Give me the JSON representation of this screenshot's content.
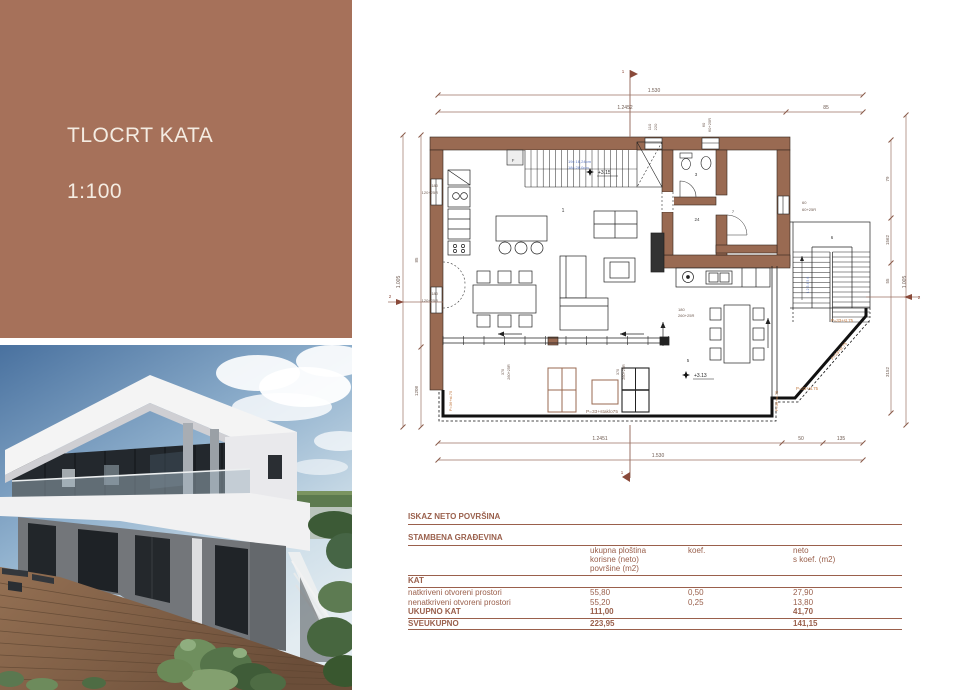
{
  "title_panel": {
    "title": "TLOCRT KATA",
    "scale": "1:100"
  },
  "colors": {
    "panel": "#a6715a",
    "wall": "#996a52",
    "dim_line": "#9b7265",
    "table_text": "#9a604c",
    "stair_note": "#5f7bc4",
    "surface_note": "#c07840"
  },
  "plan": {
    "texts": [
      {
        "t": "1.530",
        "x": 654,
        "y": 92
      },
      {
        "t": "1.2452",
        "x": 625,
        "y": 109
      },
      {
        "t": "85",
        "x": 826,
        "y": 109
      },
      {
        "t": "1",
        "x": 623,
        "y": 73,
        "s": 4.5,
        "c": "#8a4a3a"
      },
      {
        "t": "110",
        "x": 651,
        "y": 127,
        "r": -90,
        "s": 4
      },
      {
        "t": "220",
        "x": 657,
        "y": 127,
        "r": -90,
        "s": 4
      },
      {
        "t": "60",
        "x": 705,
        "y": 125,
        "r": -90,
        "s": 4
      },
      {
        "t": "60+25R",
        "x": 711,
        "y": 125,
        "r": -90,
        "s": 4
      },
      {
        "t": "79",
        "x": 889,
        "y": 179,
        "r": -90,
        "s": 4.5
      },
      {
        "t": "1562",
        "x": 889,
        "y": 240,
        "r": -90,
        "s": 4.5
      },
      {
        "t": "55",
        "x": 889,
        "y": 281,
        "r": -90,
        "s": 4.5
      },
      {
        "t": "3152",
        "x": 889,
        "y": 372,
        "r": -90,
        "s": 4.5
      },
      {
        "t": "1.005",
        "x": 906,
        "y": 282,
        "r": -90
      },
      {
        "t": "2",
        "x": 919,
        "y": 299,
        "s": 4.5,
        "c": "#8a4a3a"
      },
      {
        "t": "60",
        "x": 802,
        "y": 204,
        "s": 4,
        "a": "start"
      },
      {
        "t": "60+25R",
        "x": 802,
        "y": 211,
        "s": 4,
        "a": "start"
      },
      {
        "t": "1.005",
        "x": 400,
        "y": 282,
        "r": -90
      },
      {
        "t": "85",
        "x": 418,
        "y": 260,
        "r": -90,
        "s": 4.5
      },
      {
        "t": "1208",
        "x": 418,
        "y": 391,
        "r": -90,
        "s": 4.5
      },
      {
        "t": "2",
        "x": 390,
        "y": 298,
        "s": 4.5,
        "c": "#8a4a3a"
      },
      {
        "t": "180",
        "x": 438,
        "y": 187,
        "s": 4,
        "a": "end"
      },
      {
        "t": "120+25R",
        "x": 438,
        "y": 194,
        "s": 4,
        "a": "end"
      },
      {
        "t": "180",
        "x": 438,
        "y": 295,
        "s": 4,
        "a": "end"
      },
      {
        "t": "120+25R",
        "x": 438,
        "y": 302,
        "s": 4,
        "a": "end"
      },
      {
        "t": "1.2451",
        "x": 600,
        "y": 440
      },
      {
        "t": "50",
        "x": 801,
        "y": 440
      },
      {
        "t": "135",
        "x": 841,
        "y": 440
      },
      {
        "t": "1.530",
        "x": 658,
        "y": 457
      },
      {
        "t": "1",
        "x": 622,
        "y": 474,
        "s": 4.5,
        "c": "#8a4a3a"
      },
      {
        "t": "370",
        "x": 504,
        "y": 372,
        "r": -90,
        "s": 3.8
      },
      {
        "t": "260+25R",
        "x": 510,
        "y": 372,
        "r": -90,
        "s": 3.8
      },
      {
        "t": "370",
        "x": 619,
        "y": 372,
        "r": -90,
        "s": 3.8
      },
      {
        "t": "260+25R",
        "x": 625,
        "y": 372,
        "r": -90,
        "s": 3.8
      },
      {
        "t": "180",
        "x": 678,
        "y": 311,
        "s": 4,
        "a": "start"
      },
      {
        "t": "260+25R",
        "x": 678,
        "y": 317,
        "s": 4,
        "a": "start"
      },
      {
        "t": "1",
        "x": 563,
        "y": 212,
        "s": 5,
        "c": "#3a3a3a"
      },
      {
        "t": "3",
        "x": 696,
        "y": 176,
        "s": 4.5,
        "c": "#3a3a3a"
      },
      {
        "t": "24",
        "x": 697,
        "y": 221,
        "s": 4.5,
        "c": "#3a3a3a"
      },
      {
        "t": "7",
        "x": 733,
        "y": 213,
        "s": 4,
        "c": "#3a3a3a"
      },
      {
        "t": "6",
        "x": 832,
        "y": 239,
        "s": 4.5,
        "c": "#3a3a3a"
      },
      {
        "t": "5",
        "x": 688,
        "y": 362,
        "s": 4.5,
        "c": "#3a3a3a"
      },
      {
        "t": "+3.15",
        "x": 598,
        "y": 174,
        "s": 5,
        "a": "start",
        "c": "#222222"
      },
      {
        "t": "+3.13",
        "x": 694,
        "y": 377,
        "s": 5,
        "a": "start",
        "c": "#222222"
      },
      {
        "t": "F",
        "x": 513,
        "y": 162,
        "s": 4.5,
        "c": "#555555"
      },
      {
        "t": "19x 16,24cm",
        "x": 568,
        "y": 163,
        "s": 4,
        "c": "#5f7bc4",
        "a": "start"
      },
      {
        "t": "18x 28,0cm",
        "x": 568,
        "y": 169,
        "s": 4,
        "c": "#5f7bc4",
        "a": "start"
      },
      {
        "t": "P=33+staklo75",
        "x": 602,
        "y": 413,
        "s": 4.8,
        "c": "#8a6a58"
      },
      {
        "t": "P=33+st.75",
        "x": 831,
        "y": 322,
        "s": 4.3,
        "c": "#c07840",
        "a": "start"
      },
      {
        "t": "P=33+st.75",
        "x": 840,
        "y": 352,
        "s": 4.3,
        "c": "#c07840",
        "r": -49
      },
      {
        "t": "P=33+st.75",
        "x": 796,
        "y": 390,
        "s": 4.3,
        "c": "#c07840",
        "a": "start"
      },
      {
        "t": "P=36+st.75",
        "x": 778,
        "y": 401,
        "s": 4,
        "c": "#c07840",
        "r": -90
      },
      {
        "t": "P=36+st.75",
        "x": 452,
        "y": 401,
        "s": 4,
        "c": "#c07840",
        "r": -90
      },
      {
        "t": "1 2 3 4 5 6",
        "x": 809,
        "y": 285,
        "s": 3.5,
        "c": "#5f7bc4",
        "r": -90
      }
    ]
  },
  "table": {
    "title": "ISKAZ NETO POVRŠINA",
    "subtitle": "STAMBENA GRAĐEVINA",
    "header": {
      "col1": "ukupna ploština\nkorisne (neto)\npovršine (m2)",
      "col2": "koef.",
      "col3": "neto\ns koef. (m2)"
    },
    "group": "KAT",
    "rows": [
      {
        "label": "natkriveni otvoreni prostori",
        "area": "55,80",
        "koef": "0,50",
        "neto": "27,90"
      },
      {
        "label": "nenatkriveni otvoreni prostori",
        "area": "55,20",
        "koef": "0,25",
        "neto": "13,80"
      }
    ],
    "subtotal": {
      "label": "UKUPNO KAT",
      "area": "111,00",
      "neto": "41,70"
    },
    "total": {
      "label": "SVEUKUPNO",
      "area": "223,95",
      "neto": "141,15"
    }
  }
}
